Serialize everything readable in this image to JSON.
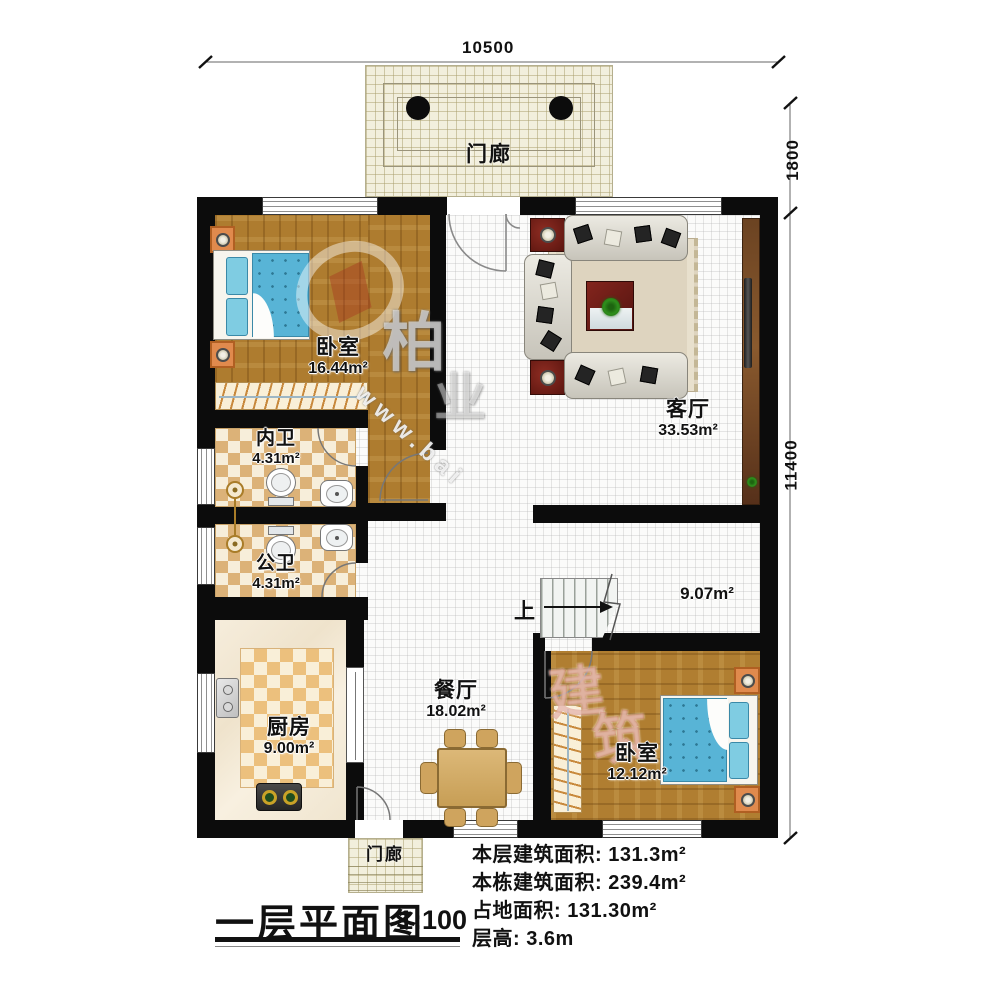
{
  "title": {
    "text": "一层平面图",
    "scale": "1:100"
  },
  "dims": {
    "top": "10500",
    "right_upper": "1800",
    "right_lower": "11400"
  },
  "porches": {
    "top": "门廊",
    "bottom": "门廊"
  },
  "rooms": {
    "bedroom1": {
      "name": "卧室",
      "area": "16.44m²"
    },
    "living": {
      "name": "客厅",
      "area": "33.53m²"
    },
    "bath_inner": {
      "name": "内卫",
      "area": "4.31m²"
    },
    "bath_public": {
      "name": "公卫",
      "area": "4.31m²"
    },
    "kitchen": {
      "name": "厨房",
      "area": "9.00m²"
    },
    "dining": {
      "name": "餐厅",
      "area": "18.02m²"
    },
    "hall": {
      "name": "",
      "area": "9.07m²"
    },
    "bedroom2": {
      "name": "卧室",
      "area": "12.12m²"
    }
  },
  "stairs": {
    "up": "上"
  },
  "stats": [
    "本层建筑面积: 131.3m²",
    "本栋建筑面积: 239.4m²",
    "占地面积: 131.30m²",
    "层高: 3.6m"
  ],
  "watermark": {
    "char1": "柏",
    "char2": "业",
    "char3": "建",
    "char4": "筑",
    "url": "www.bai"
  },
  "colors": {
    "wall": "#0c0c0c",
    "wood": "#ae7c2f",
    "bed": "#58b4d6",
    "nightstand": "#e08a4d",
    "checker_tan": "#dcb278",
    "checker_cream": "#f7eeda",
    "porch": "#f2efdd",
    "sofa": "#d9d6cd",
    "accent_red": "#6e1d16",
    "dining_wood": "#cfa45e"
  }
}
